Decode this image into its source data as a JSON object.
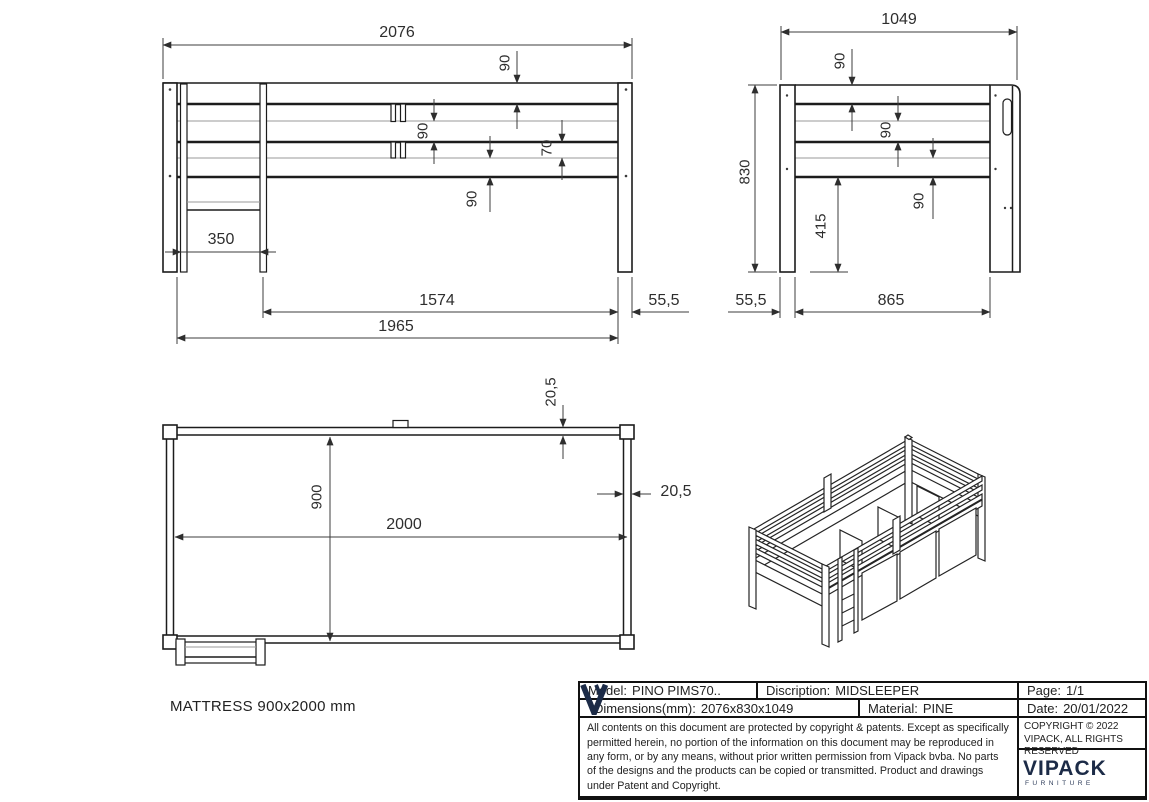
{
  "drawing": {
    "front_view": {
      "dim_total_width": "2076",
      "dim_rail_top": "90",
      "dim_rail_mid": "90",
      "dim_gap": "70",
      "dim_rail_low": "90",
      "dim_ladder_width": "350",
      "dim_span": "1574",
      "dim_overhang": "55,5",
      "dim_frame_length": "1965"
    },
    "side_view": {
      "dim_total_depth": "1049",
      "dim_rail_top": "90",
      "dim_rail_mid": "90",
      "dim_rail_low": "90",
      "dim_height": "830",
      "dim_clearance": "415",
      "dim_post_offset": "55,5",
      "dim_inner_span": "865"
    },
    "top_view": {
      "dim_rail_thickness_top": "20,5",
      "dim_rail_thickness_side": "20,5",
      "dim_width": "900",
      "dim_length": "2000"
    },
    "mattress_note": "MATTRESS 900x2000 mm"
  },
  "title_block": {
    "model_label": "Model:",
    "model_value": "PINO PIMS70..",
    "discription_label": "Discription:",
    "discription_value": "MIDSLEEPER",
    "page_label": "Page:",
    "page_value": "1/1",
    "dimensions_label": "Dimensions(mm):",
    "dimensions_value": "2076x830x1049",
    "material_label": "Material:",
    "material_value": "PINE",
    "date_label": "Date:",
    "date_value": "20/01/2022",
    "copyright_line": "COPYRIGHT © 2022 VIPACK, ALL RIGHTS RESERVED",
    "legal_text": "All contents on this document are protected by copyright & patents. Except as specifically permitted herein, no portion of the information on this document may be reproduced in any form, or by any means, without prior written permission from Vipack bvba. No parts of the designs and the products can be copied or transmitted. Product and drawings under Patent and Copyright.",
    "brand_name": "VIPACK",
    "brand_sub": "FURNITURE"
  },
  "colors": {
    "line": "#1c1c1c",
    "thin_line": "#9a9a9a",
    "dim_text": "#2e2e2e",
    "brand_navy": "#1c2b47",
    "background": "#ffffff"
  }
}
